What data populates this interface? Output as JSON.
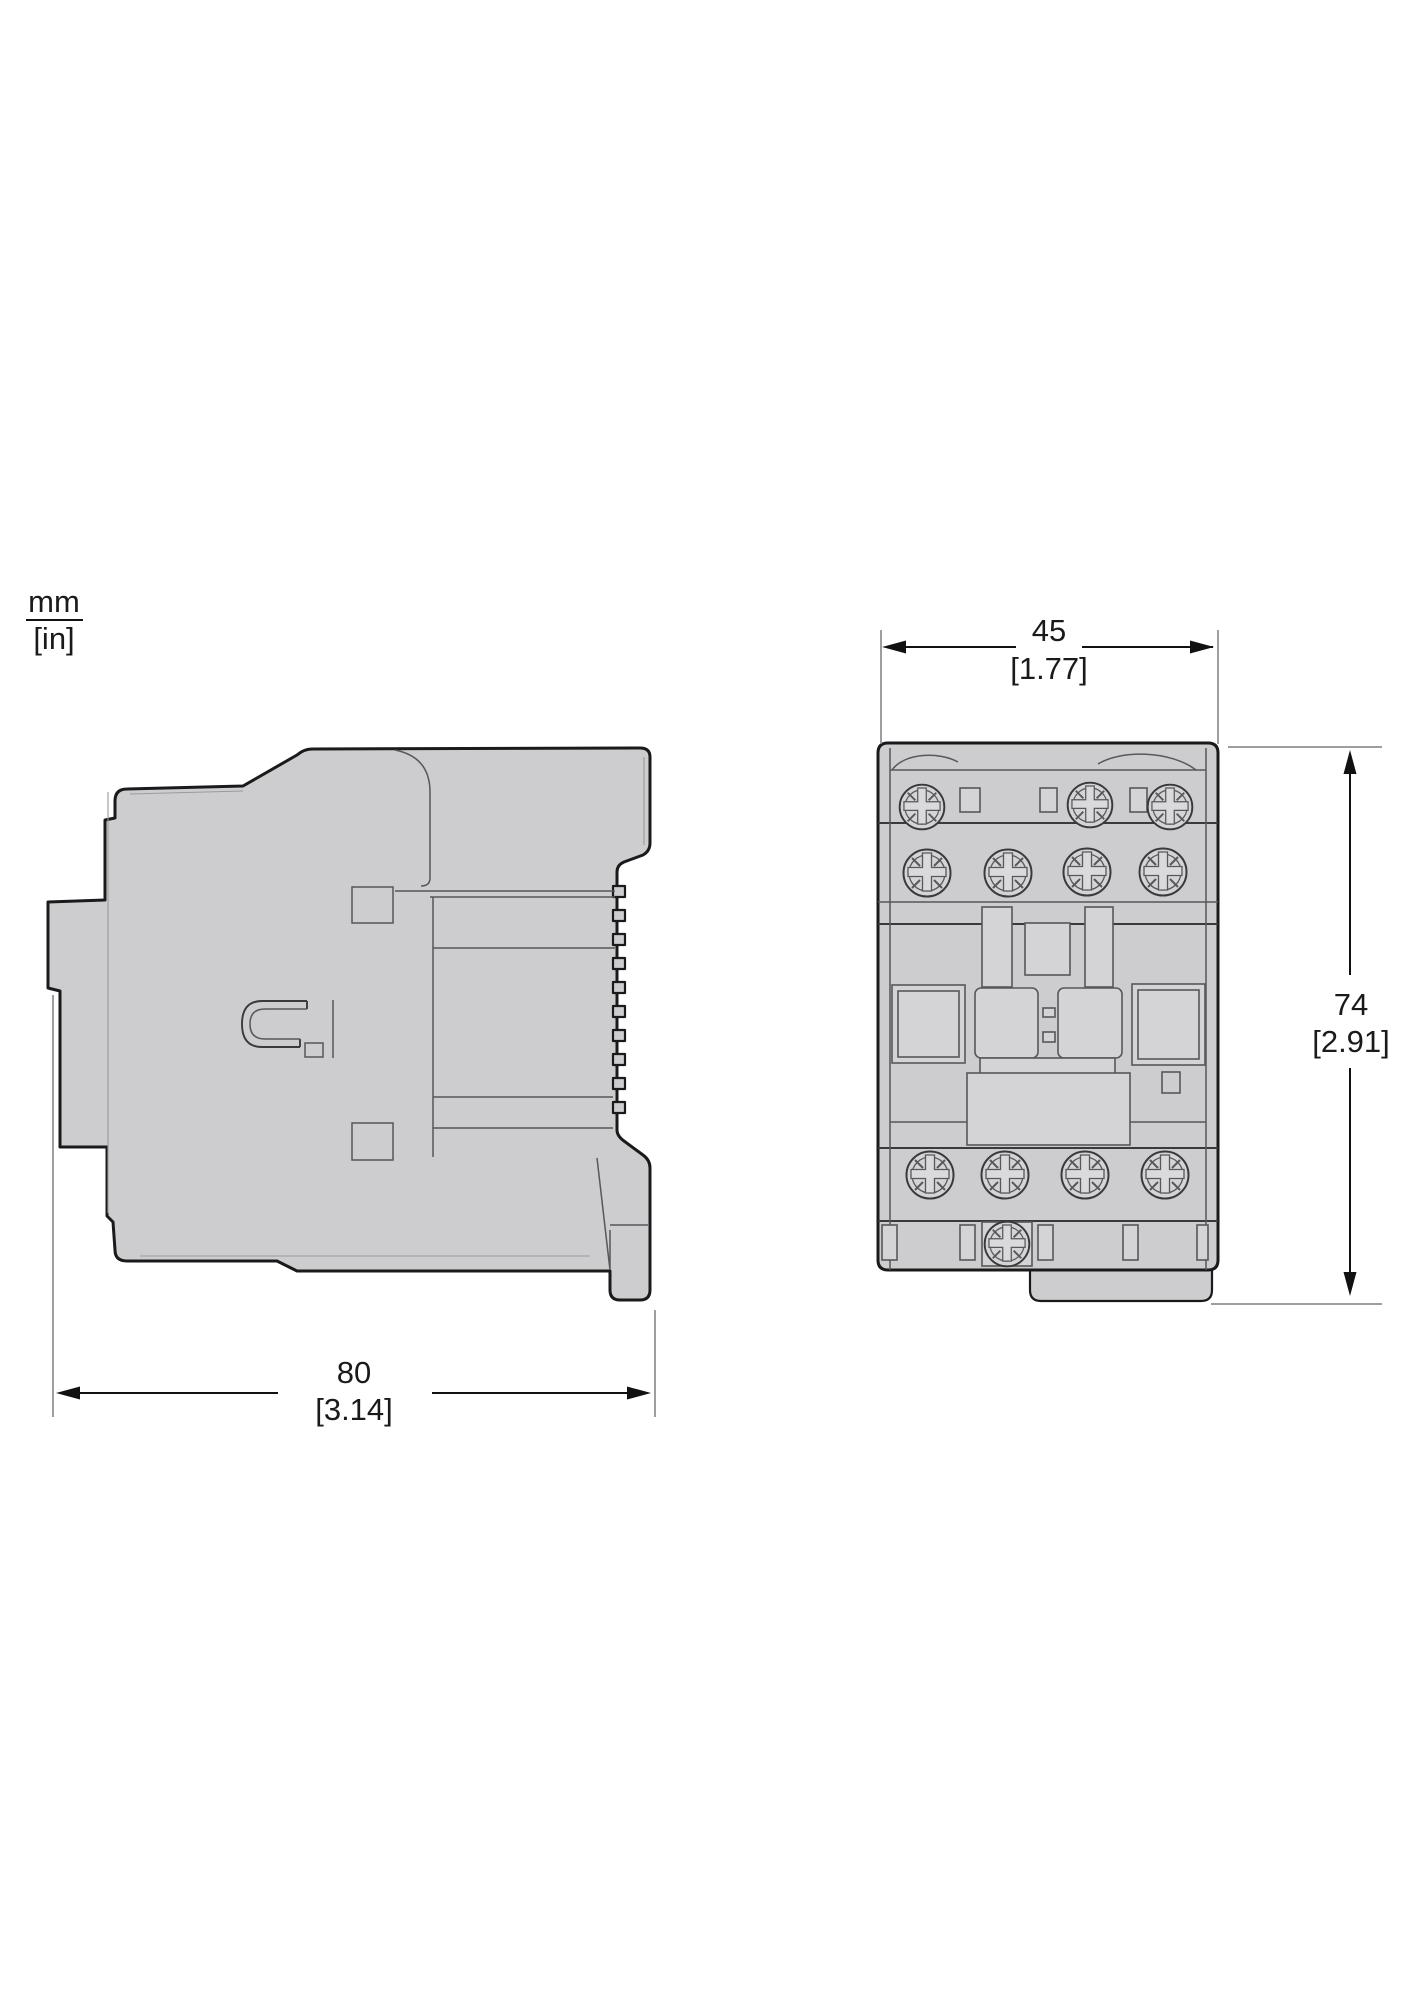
{
  "drawing": {
    "title": "contactor-dimension-drawing",
    "units": {
      "mm": "mm",
      "in": "[in]"
    },
    "dimensions": {
      "front_width": {
        "mm": "45",
        "in": "[1.77]"
      },
      "front_height": {
        "mm": "74",
        "in": "[2.91]"
      },
      "side_depth": {
        "mm": "80",
        "in": "[3.14]"
      }
    },
    "colors": {
      "body_fill": "#cdcdcf",
      "panel_fill": "#d4d4d6",
      "screw_face": "#dadadc",
      "outline": "#1a1a1a",
      "strong_line": "#3a3a3e",
      "inner_line": "#57575c",
      "light_line": "#9a9a9e",
      "dim_line": "#111111",
      "ext_line": "#7f7f83",
      "text_color": "#1a1a1a"
    }
  }
}
